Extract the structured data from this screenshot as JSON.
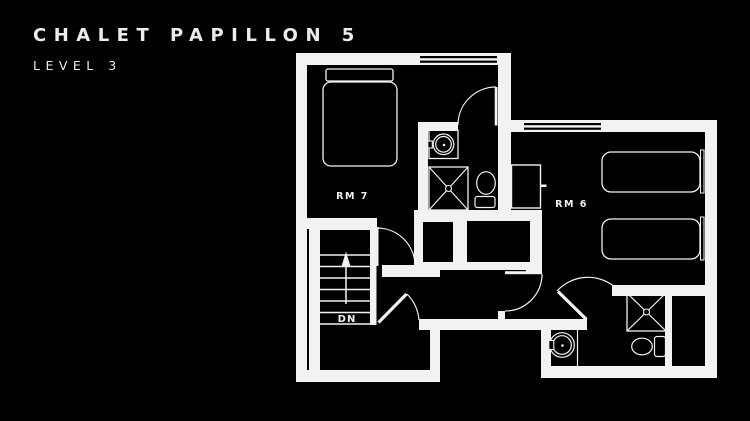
{
  "header": {
    "title": "CHALET PAPILLON 5",
    "subtitle": "LEVEL 3"
  },
  "floorplan": {
    "rooms": [
      {
        "id": "rm7",
        "label": "RM 7",
        "furniture": [
          "double-bed",
          "ensuite-sink",
          "ensuite-shower",
          "ensuite-toilet"
        ]
      },
      {
        "id": "rm6",
        "label": "RM 6",
        "furniture": [
          "single-bed",
          "single-bed",
          "closet",
          "ensuite-sink",
          "ensuite-shower",
          "ensuite-toilet"
        ]
      }
    ],
    "stairs": {
      "direction_label": "DN"
    },
    "colors": {
      "background": "#000000",
      "line": "#f2f2f2"
    }
  }
}
